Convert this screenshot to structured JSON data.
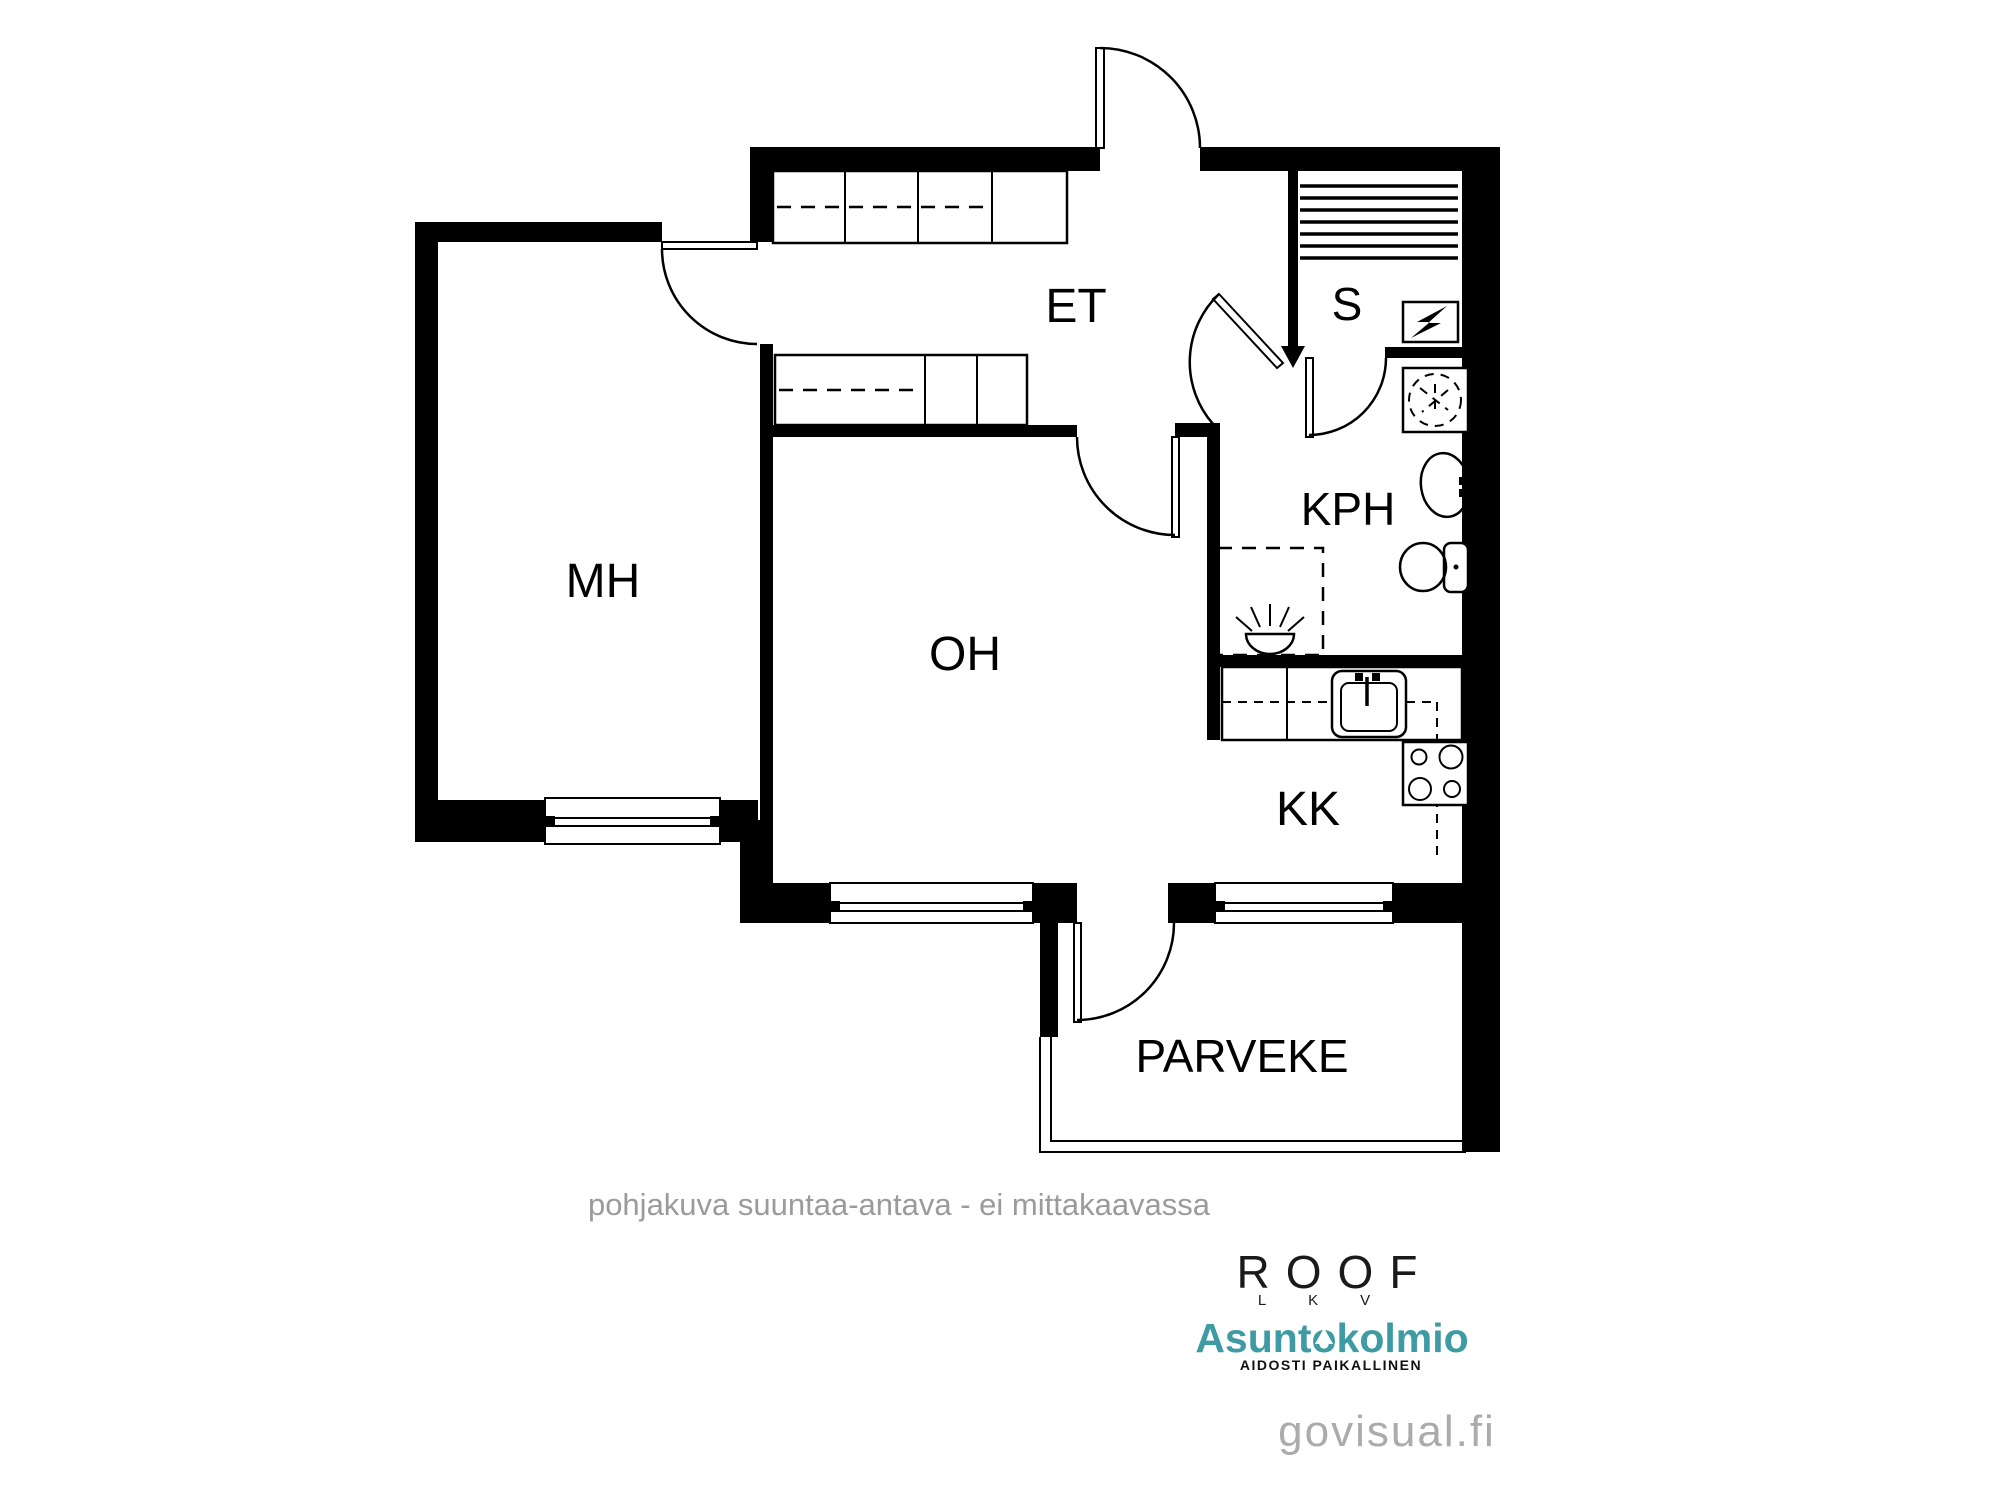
{
  "rooms": {
    "mh": {
      "label": "MH"
    },
    "oh": {
      "label": "OH"
    },
    "et": {
      "label": "ET"
    },
    "s": {
      "label": "S"
    },
    "kph": {
      "label": "KPH"
    },
    "kk": {
      "label": "KK"
    },
    "parveke": {
      "label": "PARVEKE"
    }
  },
  "disclaimer": "pohjakuva suuntaa-antava - ei mittakaavassa",
  "branding": {
    "roof_name": "ROOF",
    "roof_sub": "LKV",
    "agency_name": "Asuntokolmio",
    "agency_part1": "Asunt",
    "agency_part2": "o",
    "agency_part3": "kolmio",
    "agency_tagline": "AIDOSTI PAIKALLINEN",
    "watermark": "govisual.fi"
  },
  "colors": {
    "wall": "#000000",
    "note_gray": "#9b9b9b",
    "watermark_gray": "#ababab",
    "agency_teal": "#3f9ba3",
    "tagline_black": "#111111"
  }
}
